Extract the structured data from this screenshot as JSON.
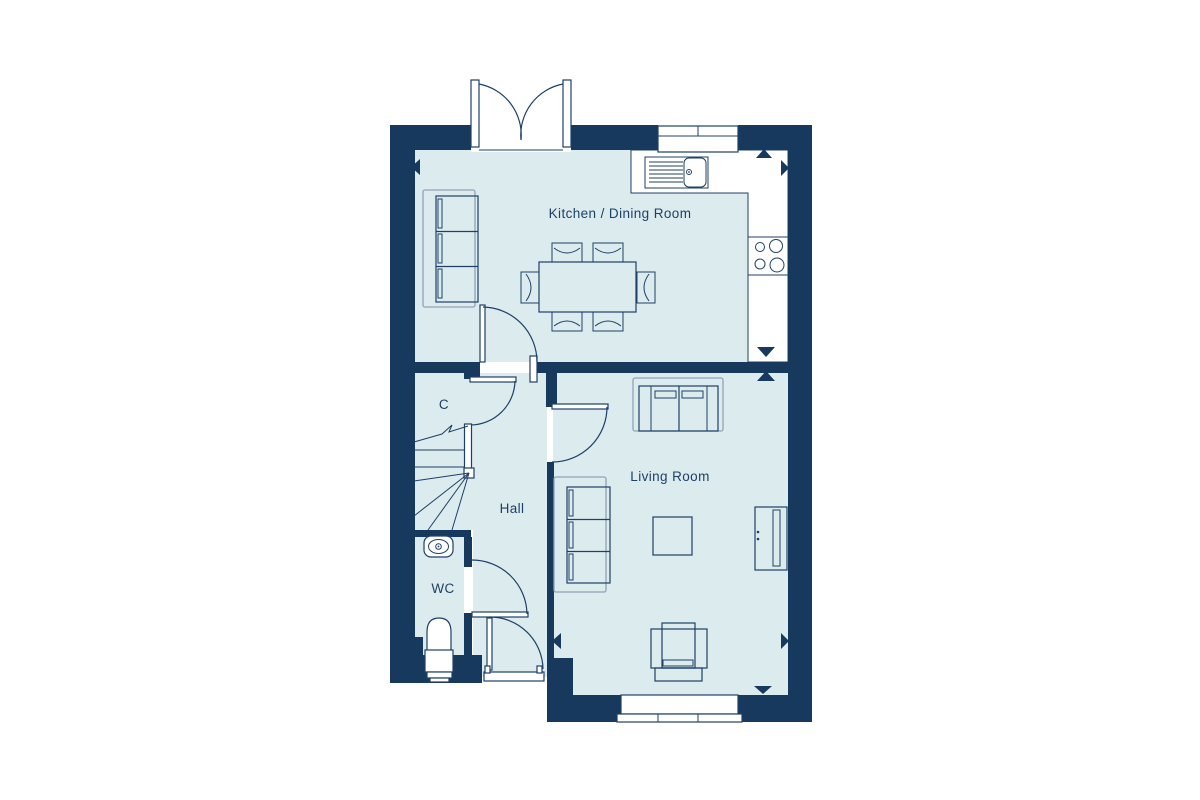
{
  "floor_plan": {
    "labels": {
      "kitchen_dining": "Kitchen / Dining Room",
      "living_room": "Living Room",
      "hall": "Hall",
      "wc": "WC",
      "cupboard": "C"
    },
    "colors": {
      "wall": "#16395d",
      "floor": "#dcebee",
      "line": "#1e4066",
      "line_soft": "#8fa3b6",
      "fixture_white": "#ffffff",
      "label_text": "#1e4066",
      "background": "#ffffff"
    }
  }
}
